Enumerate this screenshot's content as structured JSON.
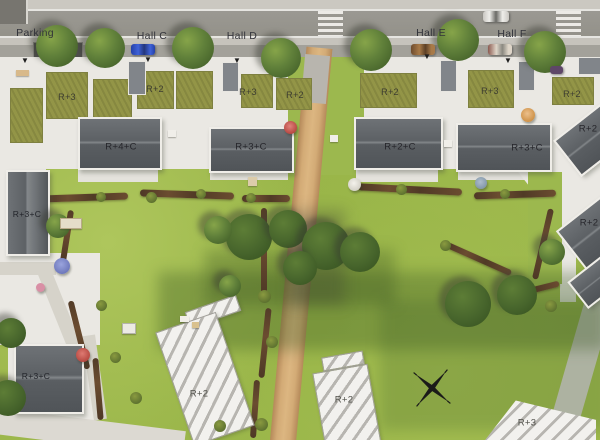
{
  "meta": {
    "description": "Aerial architectural site plan rendering of a residential development with street, halls, buildings, park and future construction plots",
    "compass_present": true
  },
  "street": {
    "parking": {
      "label": "Parking"
    },
    "halls": [
      {
        "label": "Hall C"
      },
      {
        "label": "Hall D"
      },
      {
        "label": "Hall E"
      },
      {
        "label": "Hall F"
      }
    ]
  },
  "roof_row": [
    {
      "label": "R+3"
    },
    {
      "label": "R+2"
    },
    {
      "label": "R+3"
    },
    {
      "label": "R+2"
    },
    {
      "label": "R+2"
    },
    {
      "label": "R+3"
    },
    {
      "label": "R+2"
    }
  ],
  "main_buildings": [
    {
      "label": "R+4+C"
    },
    {
      "label": "R+3+C"
    },
    {
      "label": "R+2+C"
    },
    {
      "label": "R+3+C"
    }
  ],
  "left_buildings": [
    {
      "label": "R+3+C"
    },
    {
      "label": "R+3+C"
    }
  ],
  "right_buildings": [
    {
      "label": "R+2"
    },
    {
      "label": "R+2"
    }
  ],
  "future_plots": [
    {
      "label": "R+2"
    },
    {
      "label": "R+2"
    },
    {
      "label": "R+3"
    }
  ],
  "icons": {
    "entry_arrow": "▼"
  },
  "colors": {
    "grass": "#9cb84e",
    "grass_dark": "#6f9838",
    "olive_roof": "#939547",
    "dark_roof": "#5d6165",
    "terrace_white": "#eae8e3",
    "road": "#96948e",
    "sidewalk": "#c6c3bc",
    "dirt_path": "#d3ab76",
    "hedge_brown": "#5a4029",
    "hatch_stripe": "#b7b5b0",
    "label_text": "#32333a"
  }
}
